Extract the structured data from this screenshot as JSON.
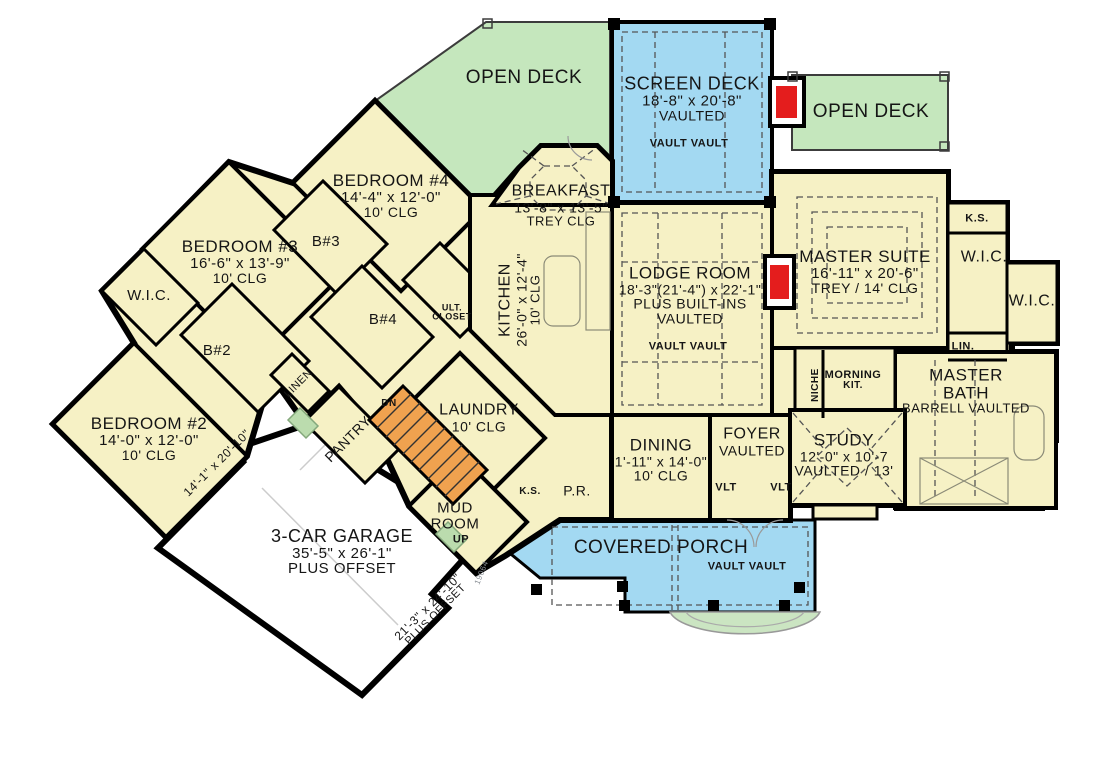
{
  "plan_number": "19064",
  "colors": {
    "room_fill": "#F6F1C5",
    "deck_green": "#C5E7BD",
    "deck_blue": "#A3D9F2",
    "stairs_orange": "#F0A24F",
    "fireplace_red": "#E41D1D",
    "wall": "#000000"
  },
  "rooms": {
    "open_deck_left": {
      "name": "OPEN DECK"
    },
    "screen_deck": {
      "name": "SCREEN DECK",
      "dim": "18'-8\" x 20'-8\"",
      "note": "VAULTED"
    },
    "open_deck_right": {
      "name": "OPEN DECK"
    },
    "bedroom4": {
      "name": "BEDROOM #4",
      "dim": "14'-4\" x 12'-0\"",
      "clg": "10' CLG"
    },
    "bedroom3": {
      "name": "BEDROOM #3",
      "dim": "16'-6\" x 13'-9\"",
      "clg": "10' CLG"
    },
    "bedroom2": {
      "name": "BEDROOM #2",
      "dim": "14'-0\" x 12'-0\"",
      "clg": "10' CLG"
    },
    "breakfast": {
      "name": "BREAKFAST",
      "dim": "13'-8\" x 13'-5\"",
      "clg": "TREY CLG"
    },
    "kitchen": {
      "name": "KITCHEN",
      "dim": "26'-0\" x 12'-4\"",
      "clg": "10' CLG"
    },
    "lodge": {
      "name": "LODGE ROOM",
      "dim": "18'-3\"(21'-4\") x 22'-1\"",
      "note": "PLUS BUILT-INS",
      "note2": "VAULTED"
    },
    "master_suite": {
      "name": "MASTER SUITE",
      "dim": "16'-11\" x 20'-6\"",
      "clg": "TREY / 14' CLG"
    },
    "master_bath": {
      "name1": "MASTER",
      "name2": "BATH",
      "note": "BARRELL VAULTED"
    },
    "dining": {
      "name": "DINING",
      "dim": "1'-11\" x 14'-0\"",
      "clg": "10' CLG"
    },
    "foyer": {
      "name": "FOYER",
      "note": "VAULTED"
    },
    "study": {
      "name": "STUDY",
      "dim": "12'-0\" x 10'-7",
      "note": "VAULTED / 13'"
    },
    "laundry": {
      "name": "LAUNDRY",
      "clg": "10' CLG"
    },
    "mud_room": {
      "name1": "MUD",
      "name2": "ROOM"
    },
    "garage": {
      "name": "3-CAR GARAGE",
      "dim": "35'-5\" x 26'-1\"",
      "note": "PLUS OFFSET"
    },
    "covered_porch": {
      "name": "COVERED PORCH"
    },
    "pantry": {
      "name": "PANTRY"
    },
    "linen": {
      "name": "LINEN"
    }
  },
  "small_labels": {
    "wic": "W.I.C.",
    "ks": "K.S.",
    "lin": "LIN.",
    "niche": "NICHE",
    "morning1": "MORNING",
    "morning2": "KIT.",
    "b2": "B#2",
    "b3": "B#3",
    "b4": "B#4",
    "ult1": "ULT.",
    "ult2": "CLOSET",
    "pr": "P.R.",
    "dn": "DN",
    "up": "UP",
    "vlt": "VLT",
    "vault_pair": "VAULT  VAULT",
    "garage_bay_dim": "14'-1\" x 20'-10\"",
    "garage_offset_dim": "21'-3\" x 24'-10\"",
    "garage_offset_note": "PLUS OFFSET"
  }
}
